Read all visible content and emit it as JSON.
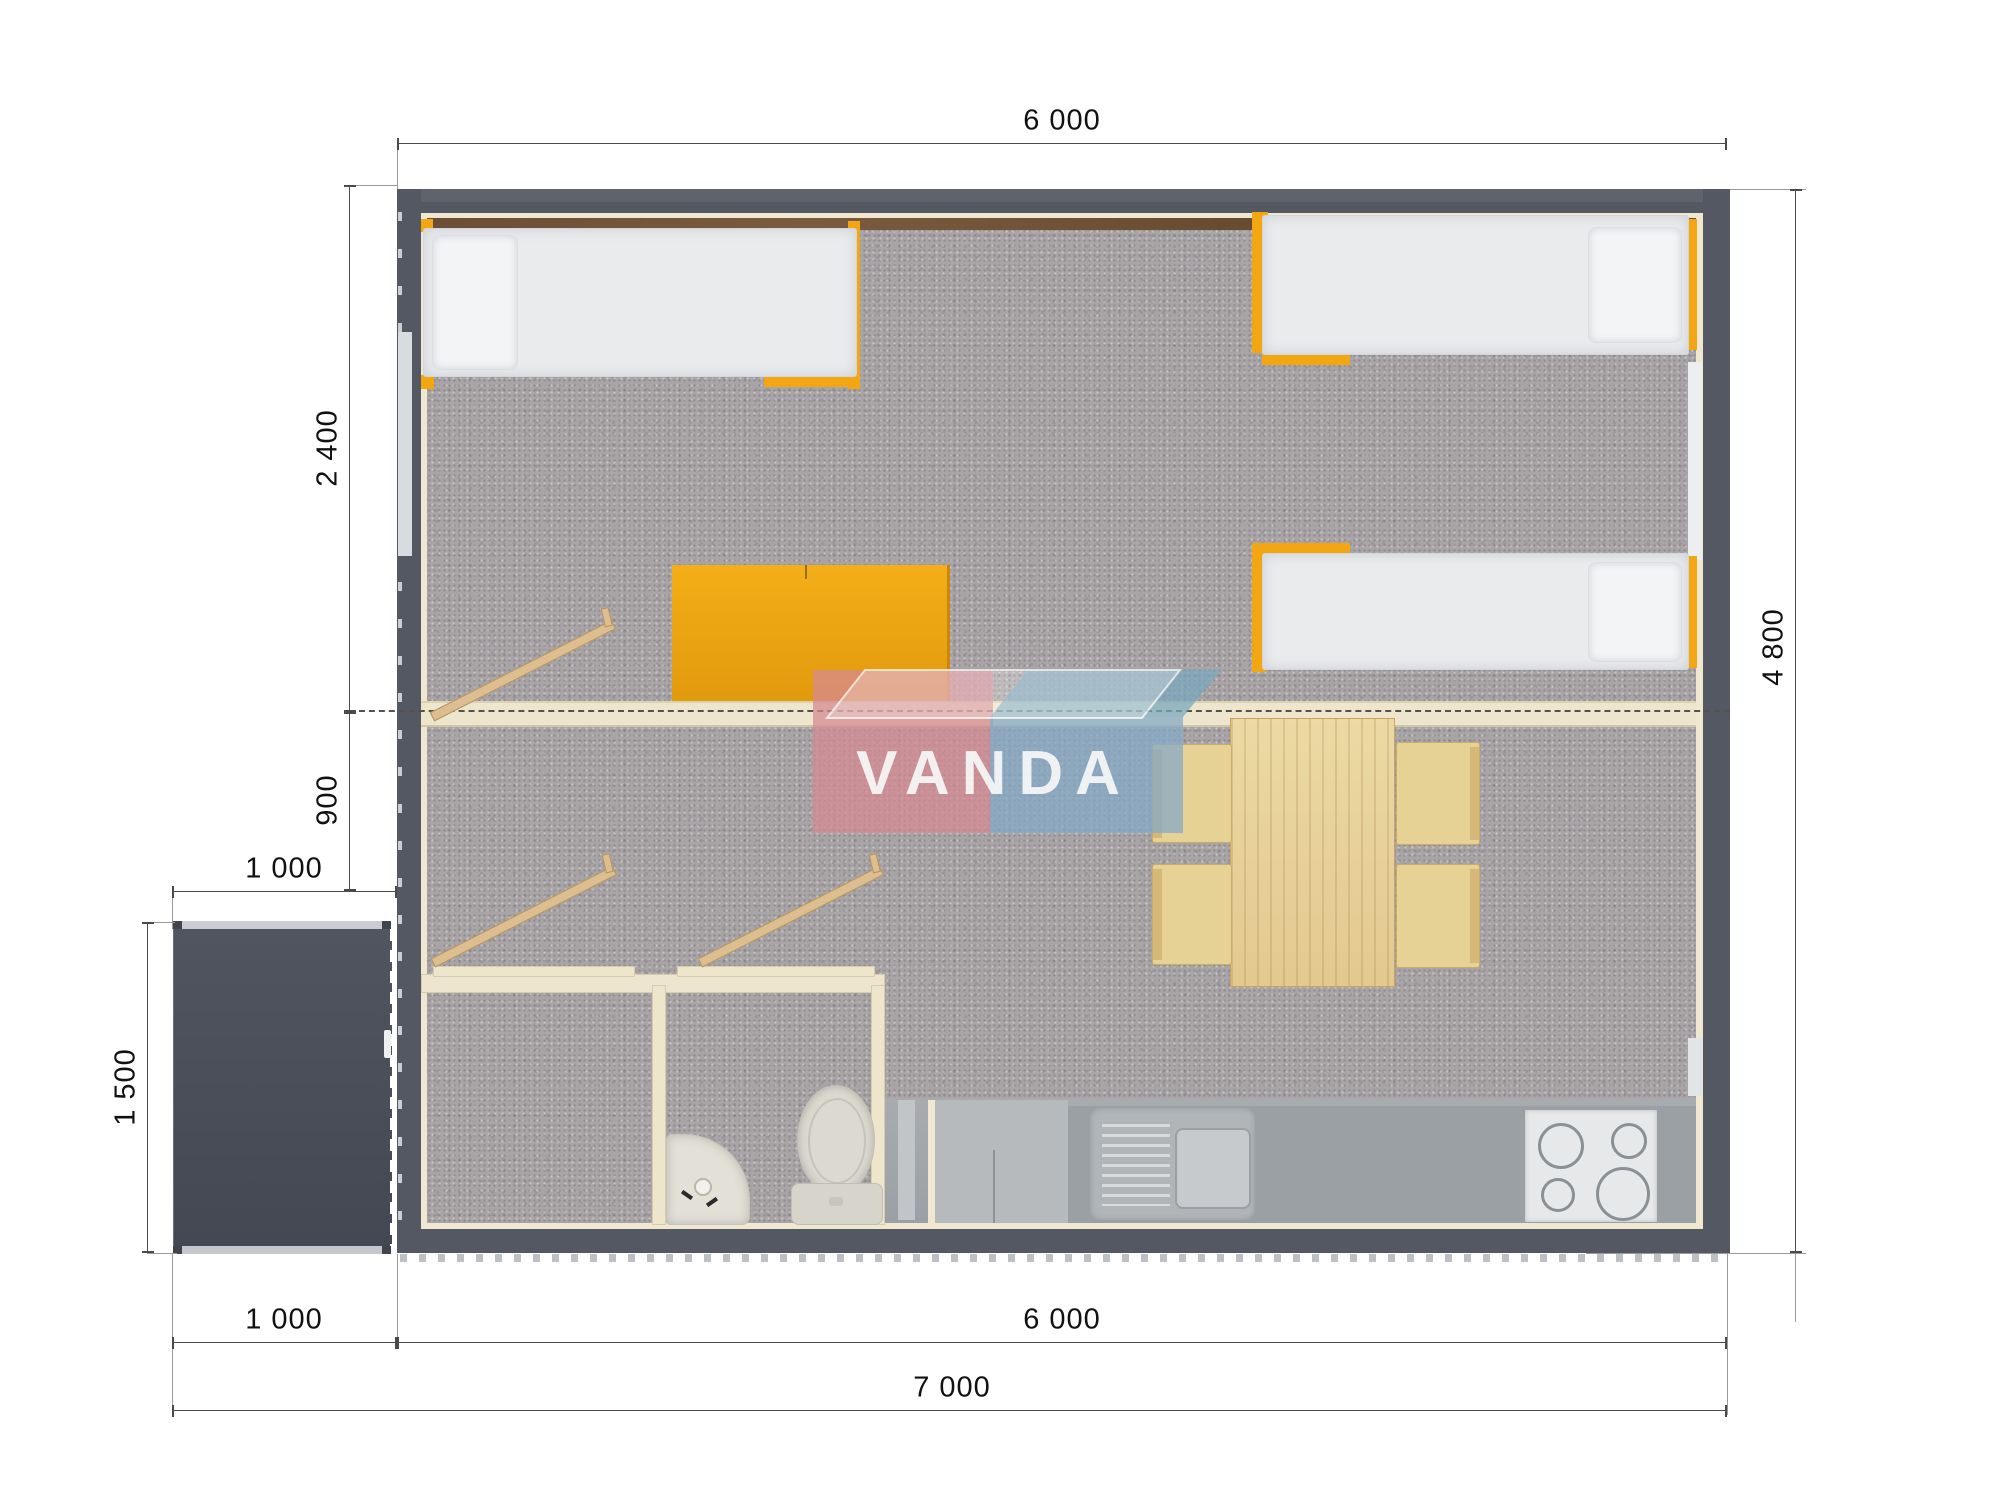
{
  "title": "house-floor-plan",
  "logo": {
    "text": "VANDA",
    "pink": "#D68992",
    "blue_front": "#85A9C7",
    "blue_top": "#79A8BD"
  },
  "dims": {
    "top_width": "6 000",
    "bedroom_depth": "2 400",
    "hall_depth": "900",
    "porch_width_top": "1 000",
    "porch_depth": "1 500",
    "side_height": "4 800",
    "bottom_porch_width": "1 000",
    "bottom_house_width": "6 000",
    "bottom_total_width": "7 000"
  },
  "colors": {
    "wall": "#535863",
    "inner_liner": "#EFE7D0",
    "carpet": "#A9A5A7",
    "accent_orange": "#F2A612",
    "wood_table": "#E7CF96",
    "porch": "#494E58",
    "counter": "#9BA0A5"
  },
  "furniture": [
    {
      "name": "bed-top-left"
    },
    {
      "name": "bed-top-right"
    },
    {
      "name": "bed-middle-right"
    },
    {
      "name": "wardrobe"
    },
    {
      "name": "dining-table"
    },
    {
      "name": "chair",
      "count": 4
    },
    {
      "name": "ladder",
      "count": 3
    },
    {
      "name": "bathroom-sink"
    },
    {
      "name": "toilet"
    },
    {
      "name": "kitchen-sink"
    },
    {
      "name": "stove"
    },
    {
      "name": "porch"
    }
  ]
}
